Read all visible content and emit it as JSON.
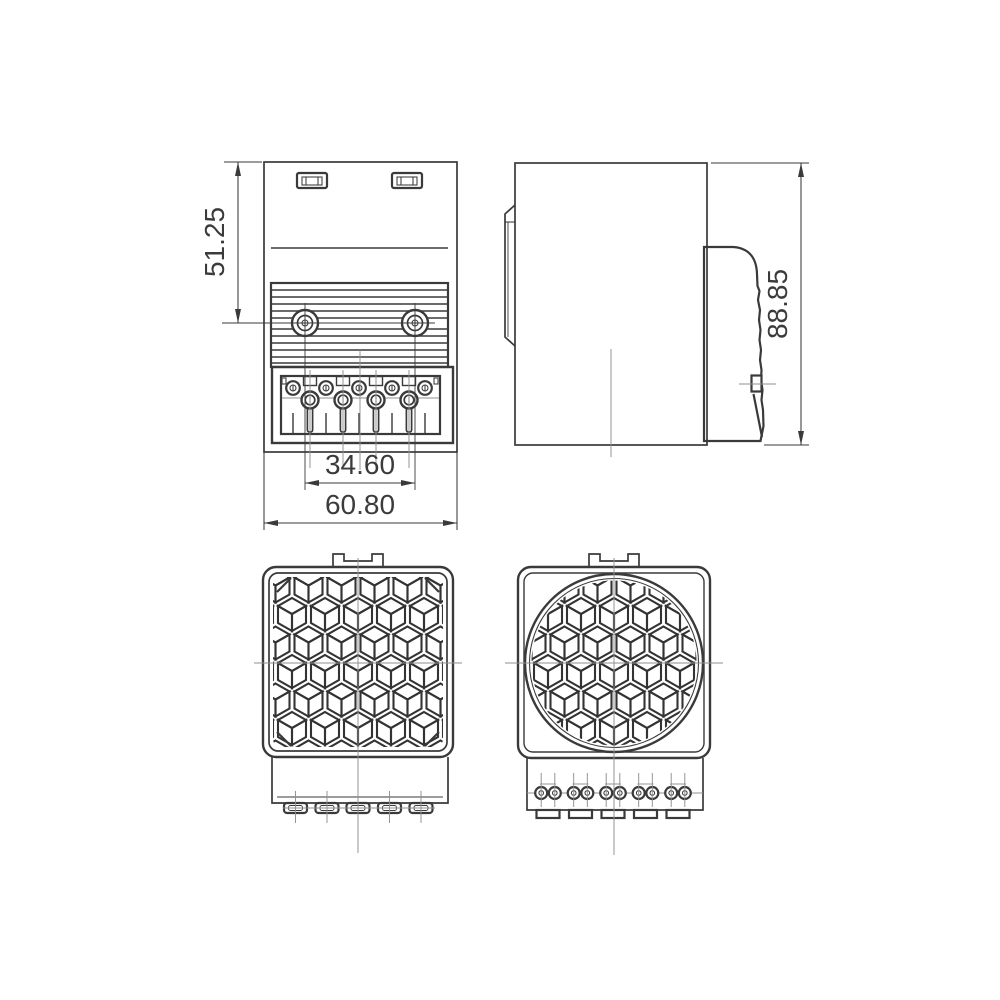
{
  "drawing": {
    "background": "#ffffff",
    "line_color": "#3a3a3a",
    "centerline_color": "#8f8f8f",
    "pattern_color": "#333333",
    "dimensions": {
      "upper_height": "51.25",
      "screw_spacing": "34.60",
      "overall_width": "60.80",
      "overall_height": "88.85"
    }
  }
}
